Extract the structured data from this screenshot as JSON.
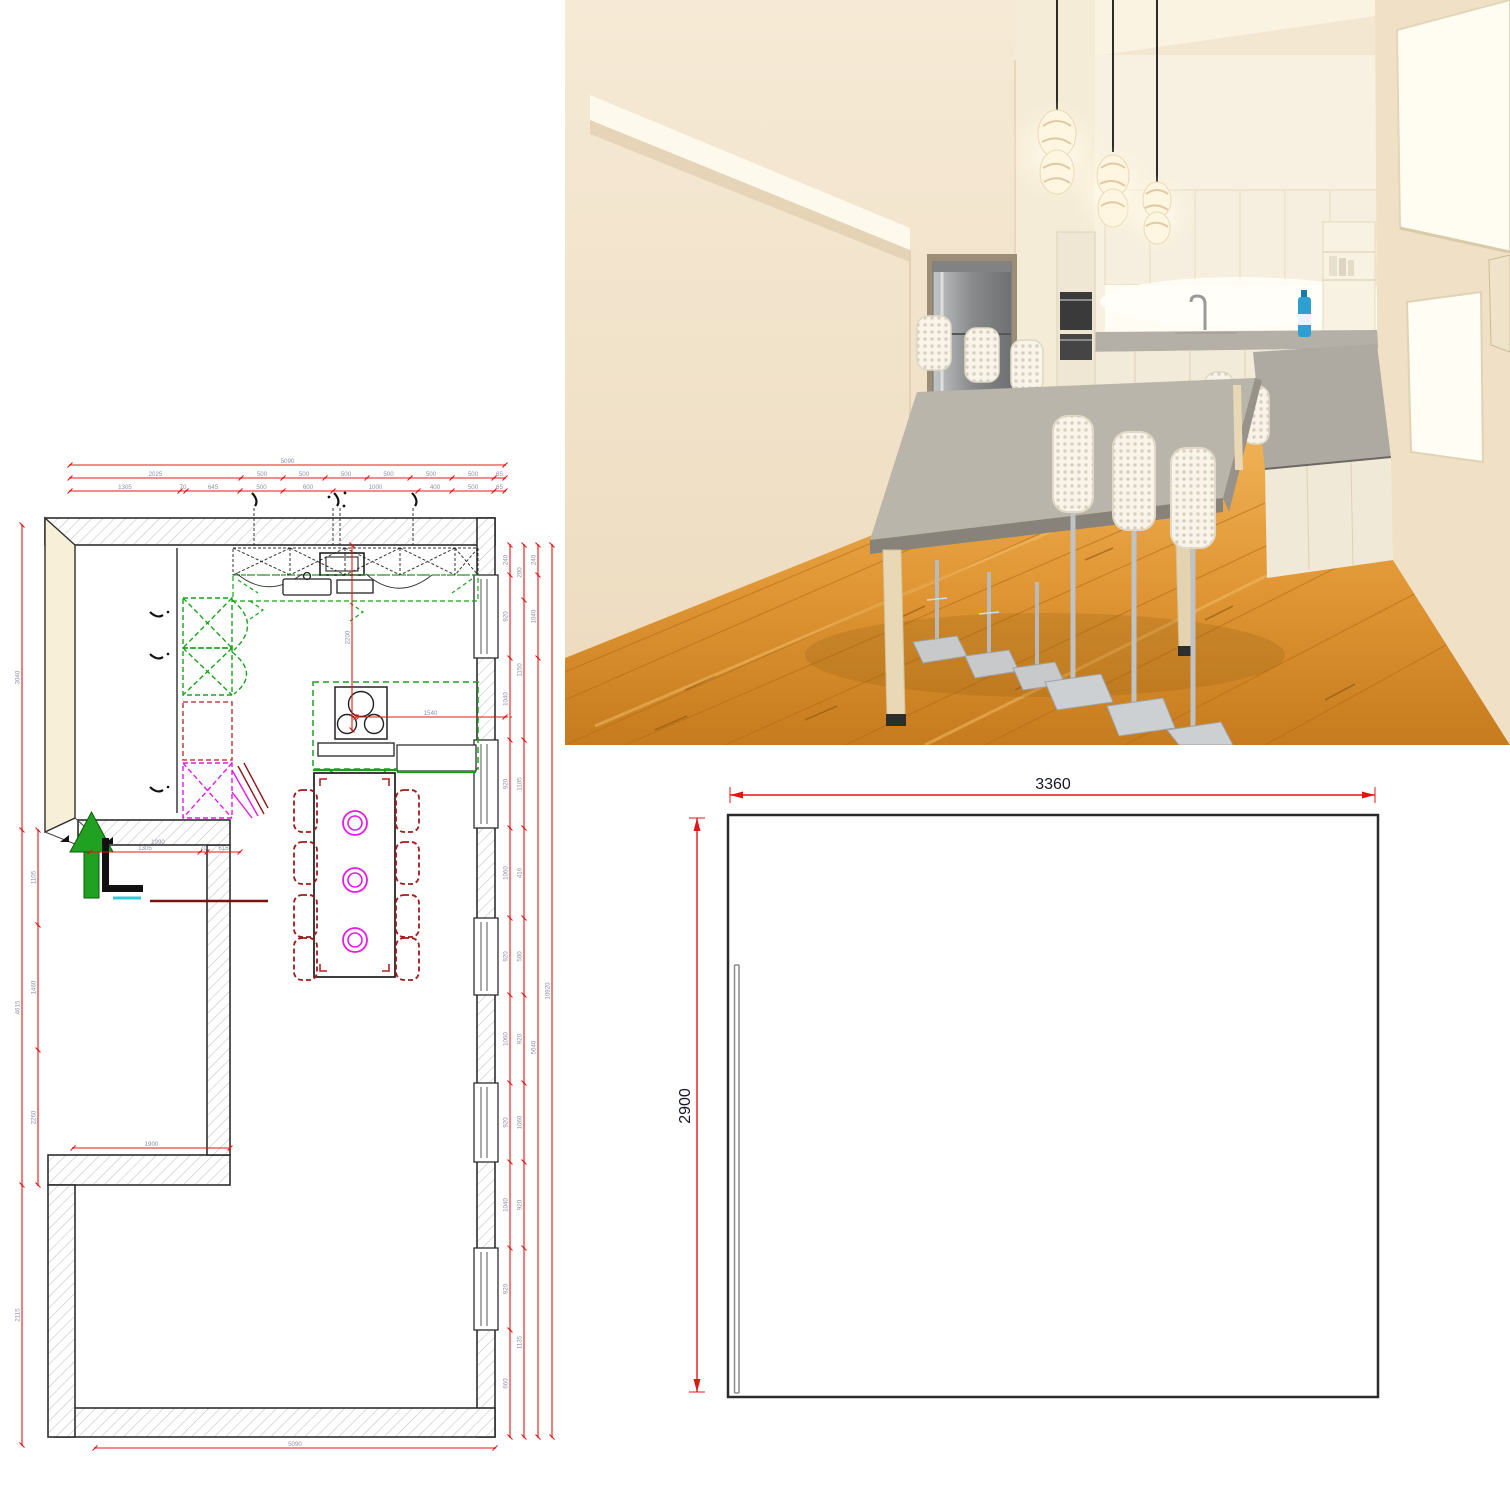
{
  "colors": {
    "dimension_red": "#e81414",
    "cabinet_green": "#19a319",
    "accent_magenta": "#e619e6",
    "chair_dark_red": "#a11b1b",
    "entrance_green": "#21a121",
    "wall_cream": "#f8efd8",
    "floor_wood": "#e2993a",
    "counter_gray": "#b7b3ab"
  },
  "floor_plan": {
    "top_dims": {
      "total": [
        "5090"
      ],
      "row2": [
        "2025",
        "500",
        "500",
        "500",
        "500",
        "500",
        "500",
        "65"
      ],
      "row3": [
        "1305",
        "70",
        "645",
        "500",
        "600",
        "1000",
        "400",
        "500",
        "65"
      ]
    },
    "bottom_dims": {
      "total": [
        "5090"
      ]
    },
    "left_dims": {
      "inner": [
        "1105",
        "1460",
        "2260"
      ],
      "outer": [
        "3040",
        "4615",
        "2115"
      ]
    },
    "right_dims": {
      "chain1": [
        "240",
        "920",
        "1040",
        "920",
        "1060",
        "920",
        "1060",
        "920",
        "1040",
        "920",
        "660"
      ],
      "chain2": [
        "200",
        "1150",
        "1105",
        "416",
        "500",
        "920",
        "1060",
        "920",
        "1135"
      ],
      "chain3": [
        "240",
        "1040",
        "5640"
      ],
      "chain4": [
        "10920"
      ]
    },
    "interior_dims": {
      "above_label": "1990",
      "entrance_row": [
        "1305",
        "70",
        "615"
      ],
      "notch": [
        "1900"
      ],
      "island_width": [
        "1540"
      ],
      "island_offset": [
        "2200"
      ]
    }
  },
  "elevation": {
    "width": "3360",
    "height": "2900"
  }
}
